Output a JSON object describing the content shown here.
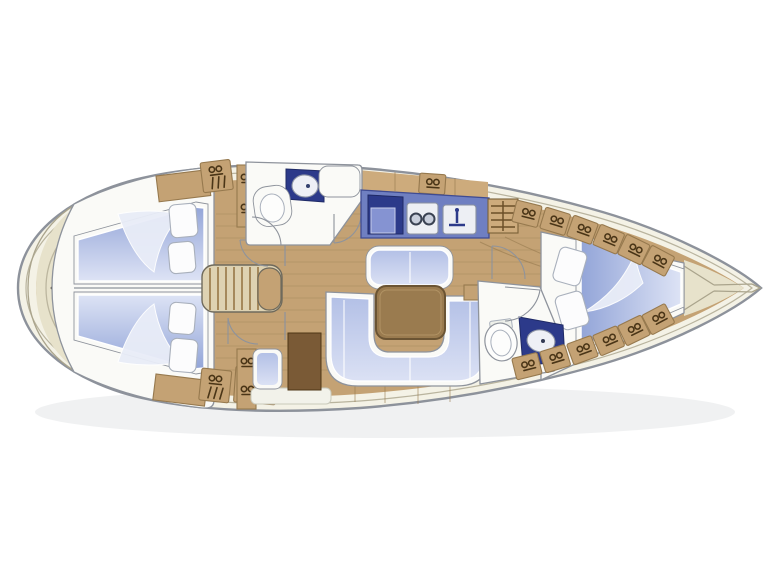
{
  "diagram": {
    "kind": "sailing-yacht-interior-floor-plan",
    "view": "top-down",
    "bow_direction": "right",
    "areas": [
      "aft-deck",
      "aft-cabin-port",
      "aft-cabin-starboard",
      "companionway-steps",
      "aft-head",
      "galley",
      "saloon",
      "nav-station",
      "forward-head",
      "forward-cabin",
      "foredeck"
    ],
    "fixtures": {
      "aft_head": [
        "toilet",
        "washbasin",
        "door"
      ],
      "galley": [
        "stove-oven",
        "twin-burners",
        "sink-with-faucet",
        "louvered-locker"
      ],
      "saloon": [
        "u-shaped-settee",
        "straight-settee",
        "dining-table",
        "side-shelf"
      ],
      "nav_station": [
        "chart-cabinet",
        "navigator-seat"
      ],
      "forward_head": [
        "toilet",
        "washbasin",
        "door"
      ],
      "berths": {
        "aft_port_pillows": 2,
        "aft_starboard_pillows": 2,
        "forward_pillows": 2
      },
      "deck": [
        "stern-fitting",
        "deck-hatches",
        "anchor-channel"
      ]
    }
  },
  "colors": {
    "hull_stroke": "#8d929b",
    "hull_band": "#f4f2e6",
    "deck": "#e7e2cb",
    "deck_line": "#aaa48c",
    "wood": "#c4a274",
    "wood_light": "#cdab7c",
    "wood_line": "#96794e",
    "glyph": "#4a3517",
    "room_fill": "#fafaf7",
    "wall": "#8e939c",
    "bed_dark": "#93a5d8",
    "bed_light": "#dde3f5",
    "cushion_dark": "#b3c0e6",
    "cushion_light": "#dbe1f4",
    "counter": "#6f7fc1",
    "navy": "#2c3a8a",
    "sink_white": "#eef0f6",
    "table_fill": "#9a7b4f",
    "table_edge": "#6b5433",
    "cabinet": "#7a5a36",
    "steps_fill": "#ded2b2",
    "steps_line": "#a5895c",
    "shadow": "#97a0a8"
  }
}
